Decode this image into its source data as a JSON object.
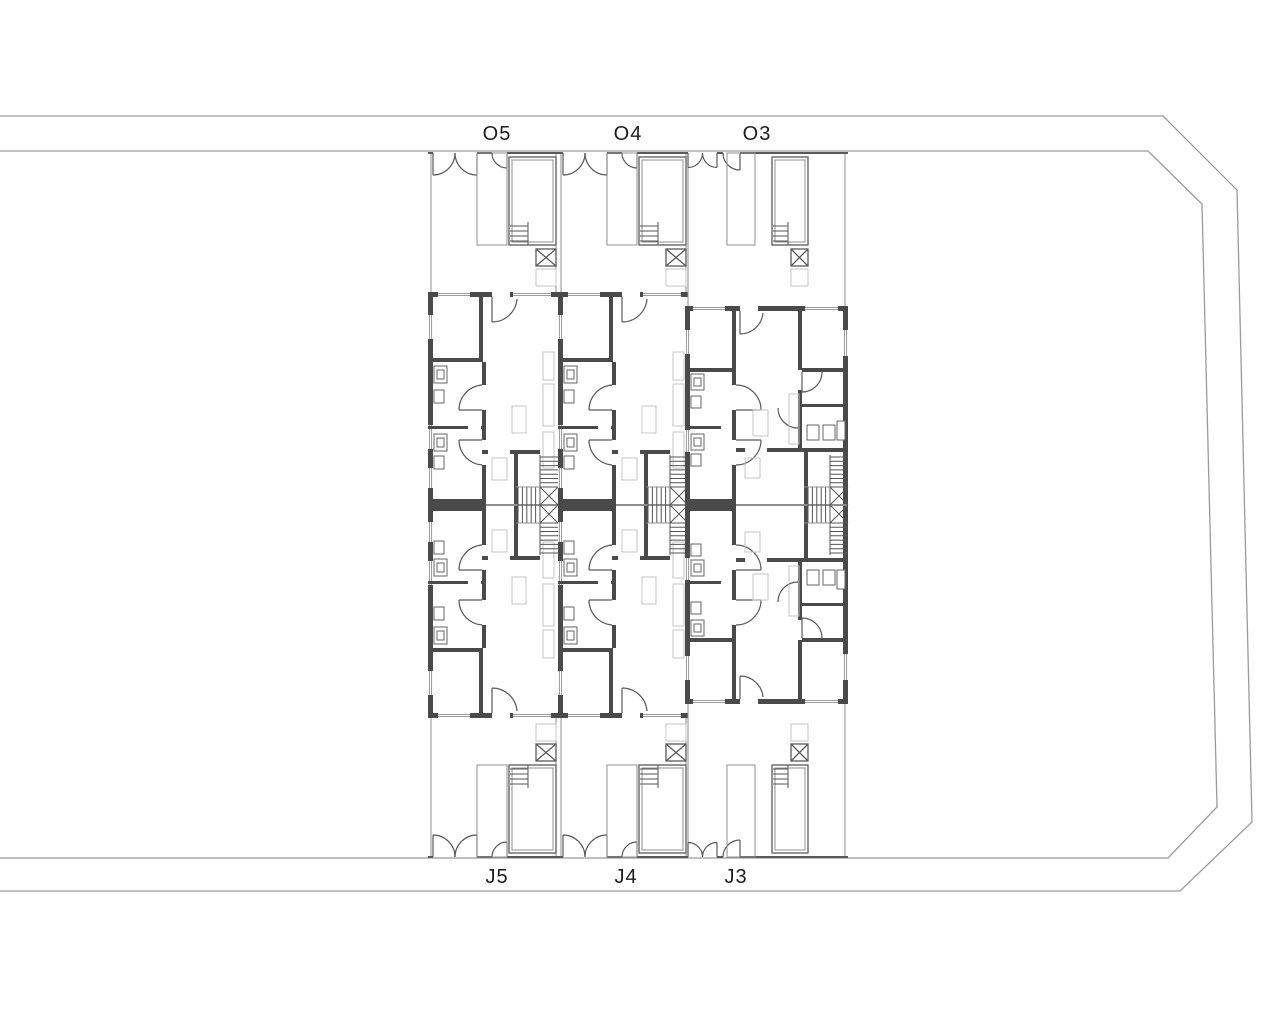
{
  "page": {
    "background_color": "#ffffff"
  },
  "site": {
    "boundary_color": "#9a9a9a",
    "label_color": "#1c1c1c",
    "top_street_labels": [
      {
        "id": "O5"
      },
      {
        "id": "O4"
      },
      {
        "id": "O3"
      }
    ],
    "bottom_street_labels": [
      {
        "id": "J5"
      },
      {
        "id": "J4"
      },
      {
        "id": "J3"
      }
    ]
  },
  "plan": {
    "wall_color": "#4a4a4a",
    "detail_line_color": "#5a5a5a",
    "thin_line_color": "#8f8f8f",
    "furniture_color": "#c4c4c4"
  }
}
